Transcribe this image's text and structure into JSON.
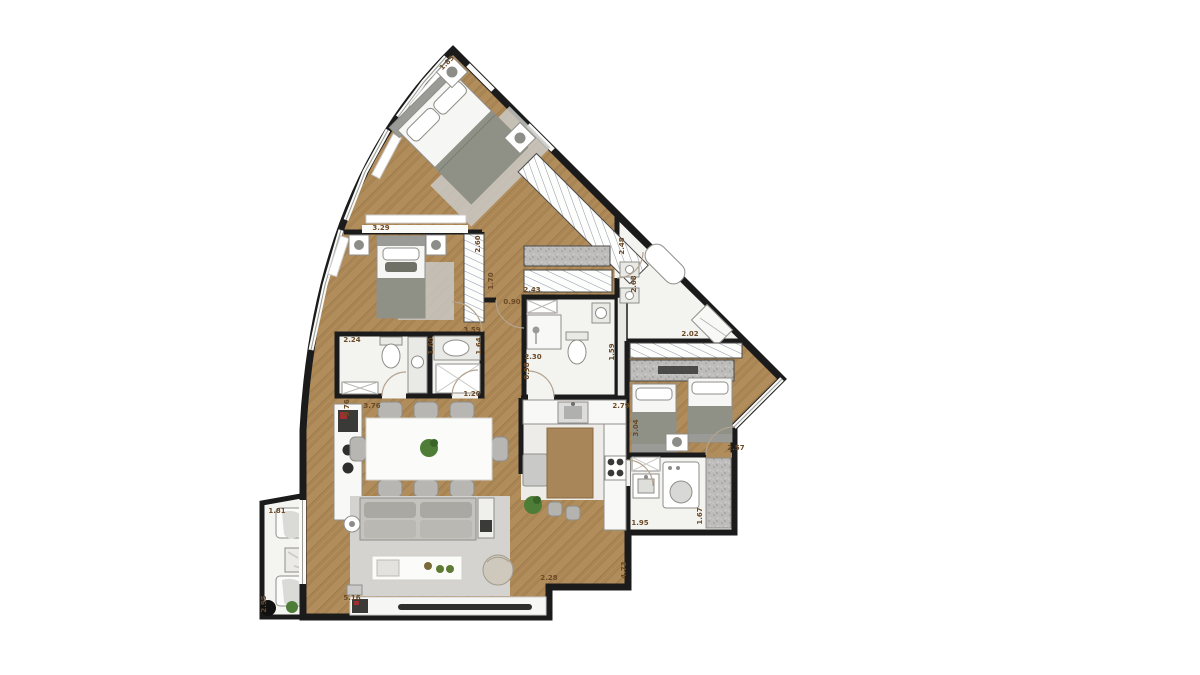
{
  "plan": {
    "colors": {
      "wall": "#1b1b1b",
      "wood_floor": "#b28d5c",
      "wood_floor_dark": "#a5824f",
      "tile_floor": "#f3f3f0",
      "kitchen_floor": "#edece8",
      "rug": "#d4d3cf",
      "upholstery_gray": "#b9b8b2",
      "blanket_gray": "#8f9086",
      "stone_counter": "#bdbcba",
      "plant_green": "#4e7d37",
      "dimension_text": "#6b4a26"
    },
    "dimensions": [
      {
        "t": "1.85",
        "x": 447,
        "y": 63,
        "r": -45
      },
      {
        "t": "3.29",
        "x": 381,
        "y": 228,
        "r": 0
      },
      {
        "t": "2.60",
        "x": 478,
        "y": 244,
        "r": -90
      },
      {
        "t": "1.70",
        "x": 491,
        "y": 281,
        "r": -90
      },
      {
        "t": "0.90",
        "x": 512,
        "y": 302,
        "r": 0
      },
      {
        "t": "2.48",
        "x": 622,
        "y": 246,
        "r": -90
      },
      {
        "t": "2.43",
        "x": 532,
        "y": 290,
        "r": 0
      },
      {
        "t": "2.68",
        "x": 634,
        "y": 284,
        "r": -90
      },
      {
        "t": "2.02",
        "x": 690,
        "y": 334,
        "r": 0
      },
      {
        "t": "2.24",
        "x": 352,
        "y": 340,
        "r": 0
      },
      {
        "t": "3.59",
        "x": 472,
        "y": 330,
        "r": 0
      },
      {
        "t": "1.60",
        "x": 431,
        "y": 346,
        "r": -90
      },
      {
        "t": "1.64",
        "x": 479,
        "y": 346,
        "r": -90
      },
      {
        "t": "2.30",
        "x": 533,
        "y": 357,
        "r": 0
      },
      {
        "t": "1.59",
        "x": 612,
        "y": 352,
        "r": -90
      },
      {
        "t": "0.98",
        "x": 527,
        "y": 371,
        "r": -90
      },
      {
        "t": "1.20",
        "x": 472,
        "y": 394,
        "r": 0
      },
      {
        "t": "3.76",
        "x": 372,
        "y": 406,
        "r": 0
      },
      {
        "t": "5.76",
        "x": 347,
        "y": 408,
        "r": -90
      },
      {
        "t": "2.79",
        "x": 621,
        "y": 406,
        "r": 0
      },
      {
        "t": "3.04",
        "x": 636,
        "y": 428,
        "r": -90
      },
      {
        "t": "2.57",
        "x": 736,
        "y": 448,
        "r": 0
      },
      {
        "t": "1.95",
        "x": 640,
        "y": 523,
        "r": 0
      },
      {
        "t": "1.67",
        "x": 700,
        "y": 516,
        "r": -90
      },
      {
        "t": "4.73",
        "x": 624,
        "y": 570,
        "r": -90
      },
      {
        "t": "2.28",
        "x": 549,
        "y": 578,
        "r": 0
      },
      {
        "t": "5.16",
        "x": 352,
        "y": 598,
        "r": 0
      },
      {
        "t": "1.81",
        "x": 277,
        "y": 511,
        "r": 0
      },
      {
        "t": "2.95",
        "x": 264,
        "y": 604,
        "r": -90
      }
    ]
  }
}
